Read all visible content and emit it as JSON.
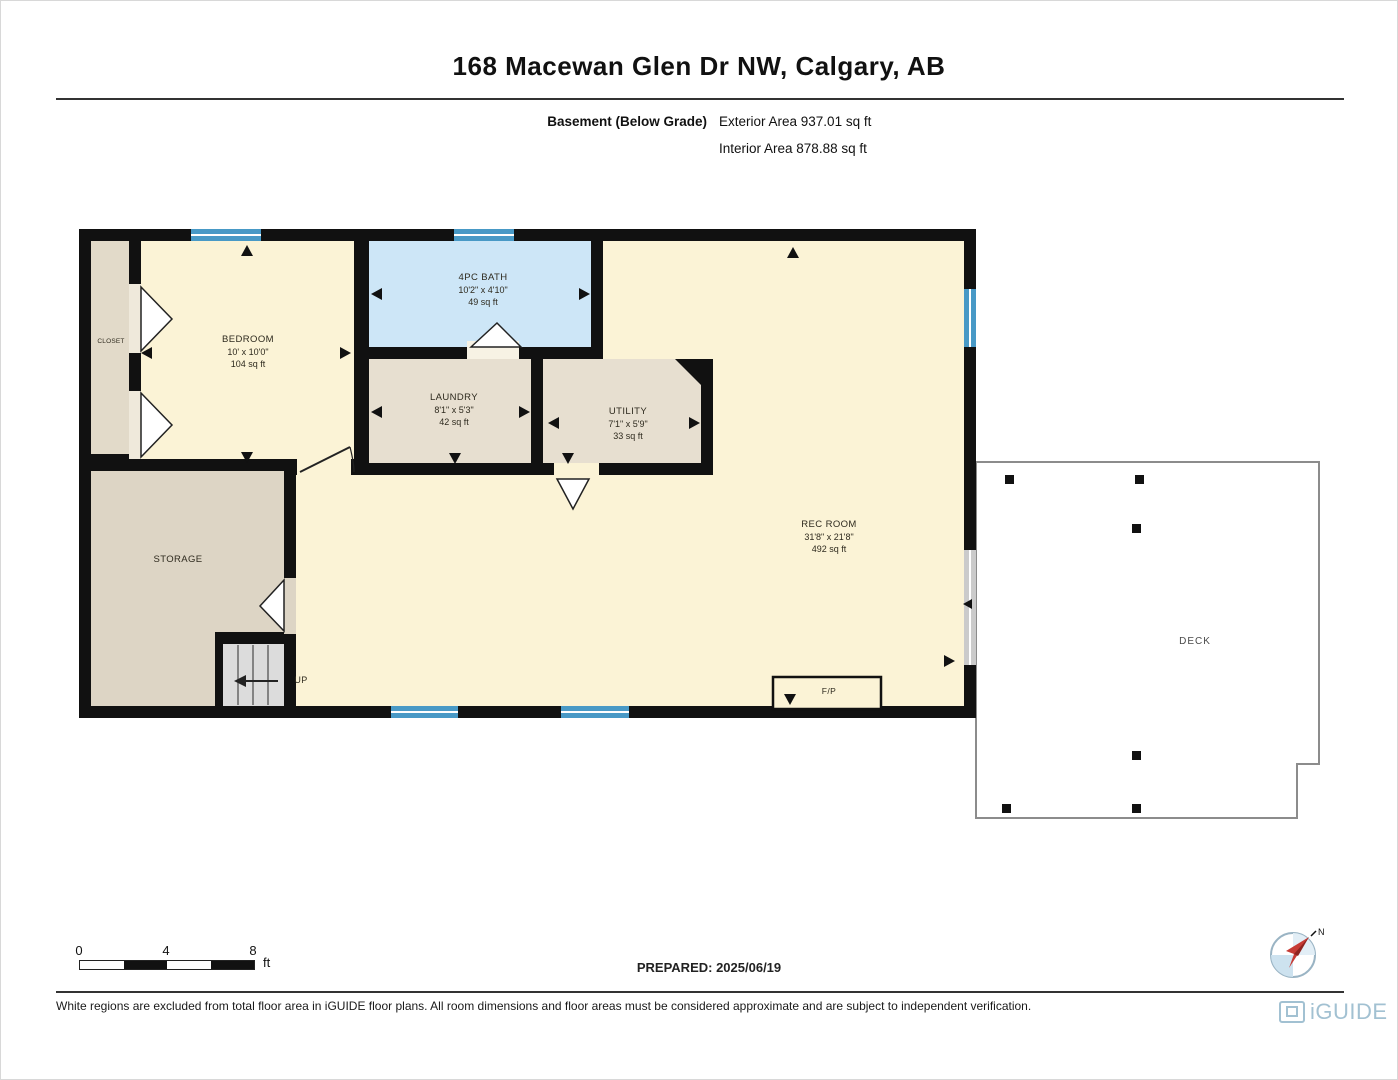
{
  "header": {
    "title": "168 Macewan Glen Dr NW, Calgary, AB",
    "floor_label": "Basement (Below Grade)",
    "exterior_area": "Exterior Area 937.01 sq ft",
    "interior_area": "Interior Area 878.88 sq ft"
  },
  "rooms": {
    "bedroom": {
      "name": "BEDROOM",
      "dims": "10' x 10'0\"",
      "area": "104 sq ft"
    },
    "closet": {
      "name": "CLOSET"
    },
    "bath": {
      "name": "4PC BATH",
      "dims": "10'2\" x 4'10\"",
      "area": "49 sq ft"
    },
    "laundry": {
      "name": "LAUNDRY",
      "dims": "8'1\" x 5'3\"",
      "area": "42 sq ft"
    },
    "utility": {
      "name": "UTILITY",
      "dims": "7'1\" x 5'9\"",
      "area": "33 sq ft"
    },
    "rec_room": {
      "name": "REC ROOM",
      "dims": "31'8\" x 21'8\"",
      "area": "492 sq ft"
    },
    "storage": {
      "name": "STORAGE"
    },
    "deck": {
      "name": "DECK"
    },
    "fireplace": {
      "name": "F/P"
    },
    "stairs": {
      "name": "UP"
    }
  },
  "scale_bar": {
    "ticks": [
      "0",
      "4",
      "8"
    ],
    "unit": "ft"
  },
  "prepared": "PREPARED: 2025/06/19",
  "compass": {
    "north_label": "N"
  },
  "footer": {
    "disclaimer": "White regions are excluded from total floor area in iGUIDE floor plans. All room dimensions and floor areas must be considered approximate and are subject to independent verification.",
    "brand": "iGUIDE"
  },
  "colors": {
    "wall": "#111111",
    "room_cream": "#fbf3d6",
    "room_tan": "#e7dfd0",
    "room_storage": "#ddd5c5",
    "room_bath_blue": "#cde6f7",
    "window_blue": "#4899c6",
    "stair_grey": "#dcdcdc",
    "deck_outline": "#8c8c8c",
    "brand_blue": "#a2c1d2",
    "compass_red": "#c63b35"
  }
}
